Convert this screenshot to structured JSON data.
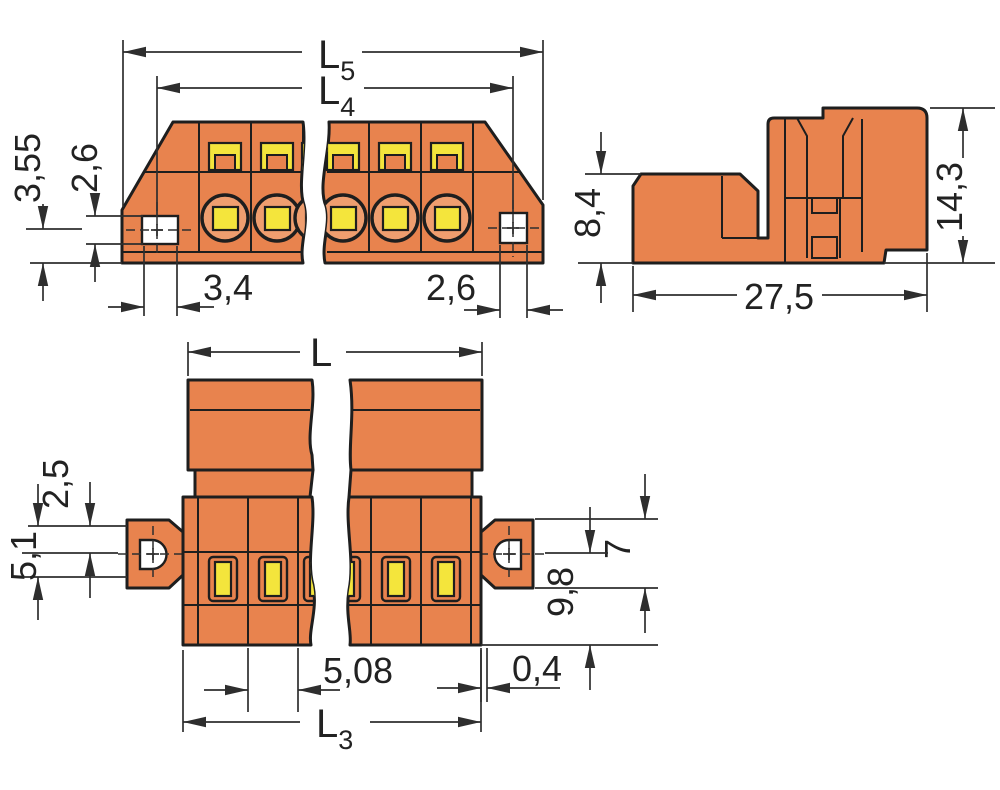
{
  "drawing": {
    "background": "#ffffff",
    "colors": {
      "body_orange": "#e8834e",
      "body_orange_light": "#ef9e6f",
      "terminal_yellow": "#f4e53c",
      "outline": "#1e1e1e",
      "dimension_lines": "#2e2e2e",
      "hole_fill": "#ffffff"
    },
    "dims": {
      "l5": {
        "base": "L",
        "sub": "5"
      },
      "l4": {
        "base": "L",
        "sub": "4"
      },
      "l": {
        "base": "L"
      },
      "l3": {
        "base": "L",
        "sub": "3"
      },
      "side_left_total": "3,55",
      "side_left_inner": "2,6",
      "side_flange_left": "3,4",
      "side_flange_right": "2,6",
      "profile_front_height": "8,4",
      "profile_total_height": "14,3",
      "profile_length": "27,5",
      "plan_left_inner": "2,5",
      "plan_left_total": "5,1",
      "plan_flange_height": "7",
      "plan_depth": "9,8",
      "plan_pitch": "5,08",
      "plan_edge_gap": "0,4"
    }
  }
}
